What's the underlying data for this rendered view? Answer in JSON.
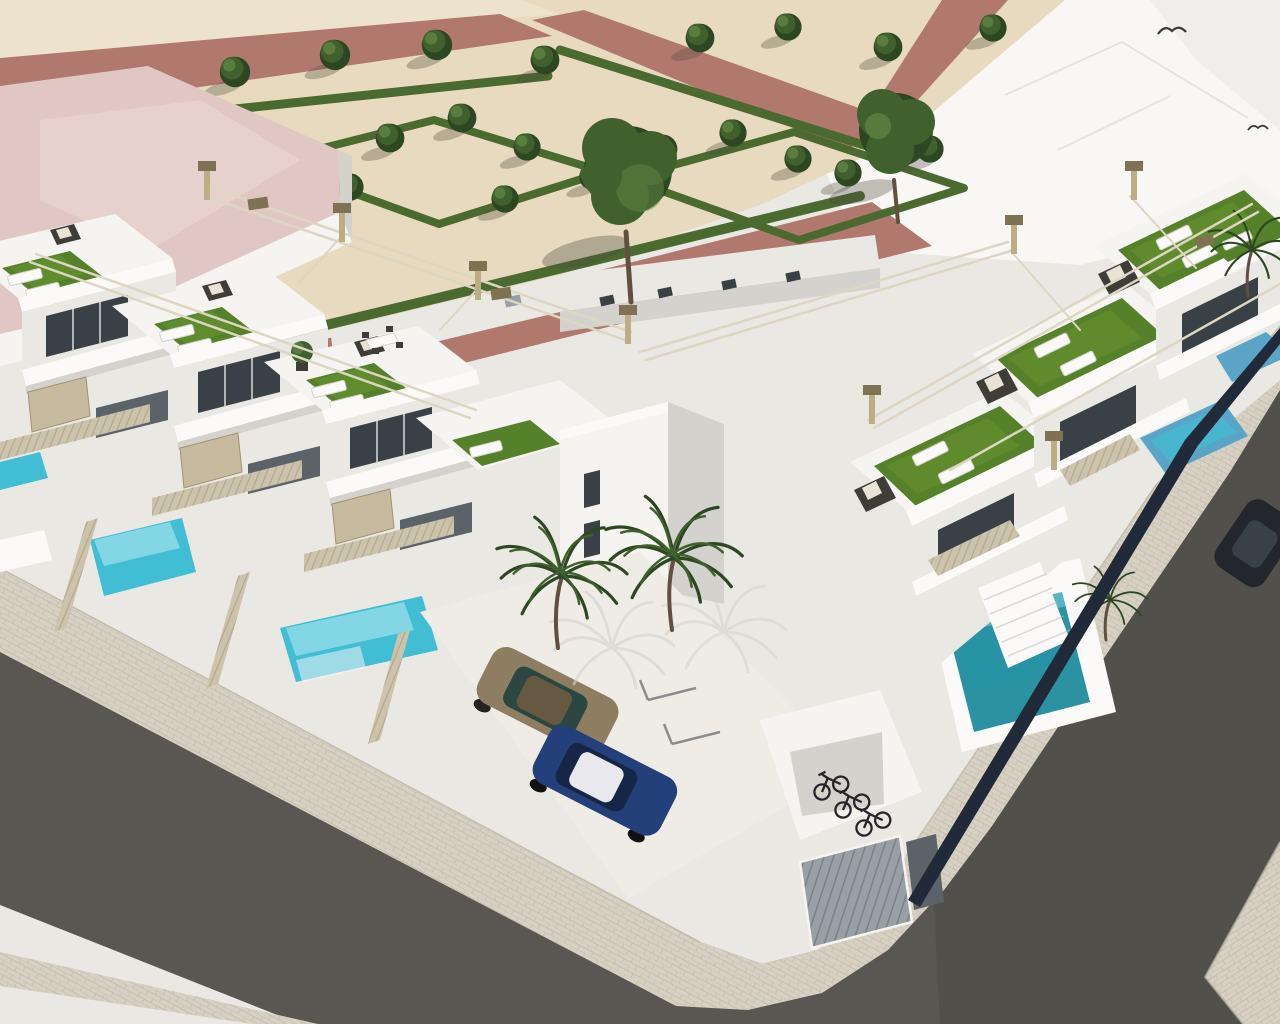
{
  "image": {
    "kind": "architectural-3d-render",
    "width": 1280,
    "height": 1024,
    "description": "Aerial 3D rendering of a modern white townhouse development on a street corner: rooftop terraces with artificial turf, sun loungers and rattan lounge sets under slim pergola rails, private turquoise plunge pools behind beige slatted fences, a landscaped park with geometric hedges, trees and dusty-rose paths, palm trees, parked cars, a bicycle alcove and grey asphalt streets with paved sidewalks."
  },
  "scene": {
    "palette": {
      "bg_pale": "#eae8e3",
      "white_zone": "#f8f7f4",
      "bright": "#fbfaf8",
      "sand": "#e7dabf",
      "sand_light": "#efe6d1",
      "path_rose": "#b1796e",
      "path_rose_dark": "#9b695f",
      "hedge": "#4b6a30",
      "hedge_dark": "#3a5425",
      "tree": "#40602e",
      "tree_light": "#5e8342",
      "tree_dark": "#2d4722",
      "trunk": "#5f5040",
      "turf": "#55812a",
      "turf_light": "#6d9c33",
      "wall_white": "#f5f4f0",
      "wall_light": "#e9e8e3",
      "wall_shadow": "#d3d2cd",
      "wall_dark": "#b9b8b3",
      "wall_deep": "#9f9e99",
      "glass": "#394046",
      "glass_light": "#5b6268",
      "tan_panel": "#c7ba9e",
      "tan_dark": "#a19370",
      "slat_fence": "#ccc3ac",
      "slat_line": "#a89c80",
      "pergola": "#ddd6c2",
      "post": "#bcad85",
      "post_cap": "#7e7252",
      "rattan": "#3e3d38",
      "cushion": "#e9e3d3",
      "pool_light": "#93dde9",
      "pool_mid": "#41bdd4",
      "pool_deep": "#2595aa",
      "pool_teal": "#2a92a1",
      "pool_teal_dark": "#1e7280",
      "pool_blue": "#5aa5c7",
      "asphalt": "#585751",
      "asphalt_dark": "#4a4a44",
      "sidewalk": "#d7d1c3",
      "sidewalk_line": "#b7b0a0",
      "navy": "#212a39",
      "car_blue": "#23407a",
      "car_blue_dark": "#152647",
      "car_roof_white": "#e9e8ec",
      "car_bronze": "#8d7d61",
      "car_bronze_dark": "#665942",
      "car_glass": "#2c4742",
      "car_dark": "#23272d",
      "bike": "#24242a",
      "roof_pink": "#e1c7c3",
      "roof_pink_light": "#ecd9d5",
      "garage": "#98a0a5",
      "garage_dark": "#6f777d",
      "shadow": "#4e4a3c",
      "court": "#efece5"
    },
    "objects": {
      "park_trees_small": 20,
      "park_trees_large": 2,
      "palm_trees": 4,
      "rooftop_turf_terraces": 8,
      "sun_loungers": 12,
      "rattan_lounge_sets": 4,
      "pools_front_row": 3,
      "pools_right_row": 2,
      "pool_corner_teal": 1,
      "cars": [
        "bronze-hatchback",
        "blue-hatchback",
        "dark-parked-car"
      ],
      "bicycles": 3,
      "birds": 2,
      "garage_doors": 1,
      "pink_roof_building": 1,
      "streets": 2
    }
  }
}
